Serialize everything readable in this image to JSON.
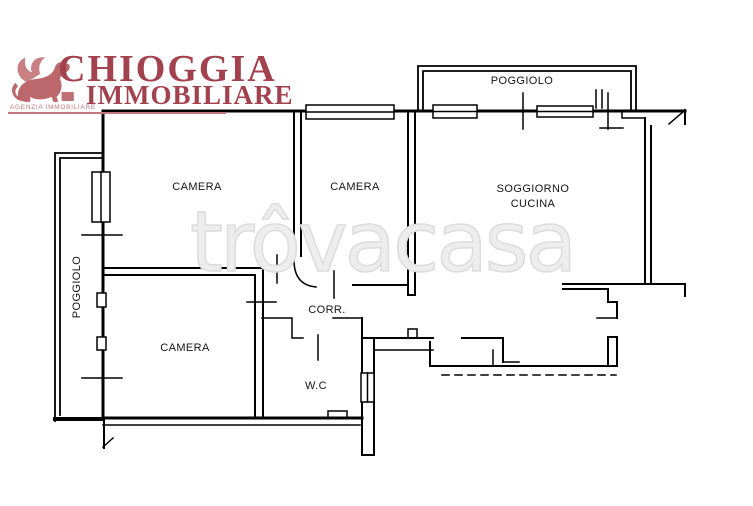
{
  "logo": {
    "name_line1": "CHIOGGIA",
    "name_line2": "IMMOBILIARE",
    "tagline": "AGENZIA IMMOBILIARE",
    "text_color": "#a2424e",
    "tagline_color": "#c4777c",
    "lion_color": "#b5565c",
    "lion_icon": "winged-lion"
  },
  "watermark": {
    "text": "trôvacasa",
    "color": "#e0e0e0"
  },
  "floorplan": {
    "wall_color": "#000000",
    "labels": [
      {
        "id": "poggiolo-top",
        "text": "POGGIOLO"
      },
      {
        "id": "poggiolo-left",
        "text": "POGGIOLO"
      },
      {
        "id": "camera-top-left",
        "text": "CAMERA"
      },
      {
        "id": "camera-middle",
        "text": "CAMERA"
      },
      {
        "id": "soggiorno",
        "text": "SOGGIORNO"
      },
      {
        "id": "cucina",
        "text": "CUCINA"
      },
      {
        "id": "camera-bottom",
        "text": "CAMERA"
      },
      {
        "id": "corridoio",
        "text": "CORR."
      },
      {
        "id": "wc",
        "text": "W.C"
      }
    ]
  }
}
